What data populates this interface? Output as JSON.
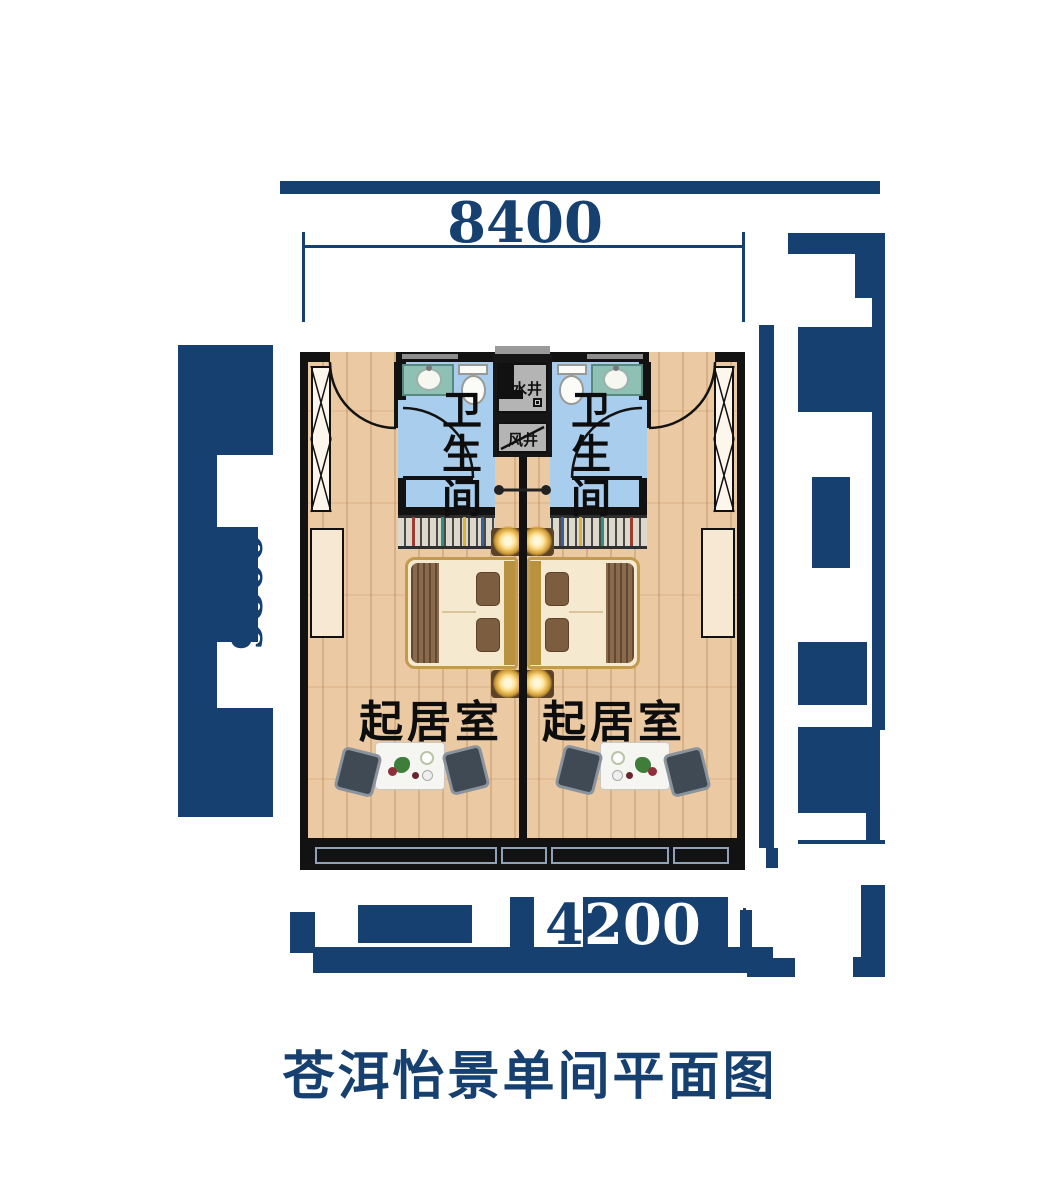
{
  "title": "苍洱怡景单间平面图",
  "dimensions": {
    "top": "8400",
    "left": "9800",
    "bottom": {
      "value": "4200",
      "lead": "4",
      "rest": "200"
    }
  },
  "shafts": {
    "top_label": "水井",
    "bottom_label": "风井"
  },
  "units": [
    {
      "side": "left",
      "bathroom_label": "卫生间",
      "living_label": "起居室"
    },
    {
      "side": "right",
      "bathroom_label": "卫生间",
      "living_label": "起居室"
    }
  ],
  "colors": {
    "navy": "#16406f",
    "wood_floor": "#ebc9a2",
    "bathroom_floor": "#a9cdec",
    "wall_black": "#121212",
    "bed_gold": "#c49a4e",
    "bedding_cream": "#f5ead0",
    "vanity_teal": "#8fc0b4"
  }
}
